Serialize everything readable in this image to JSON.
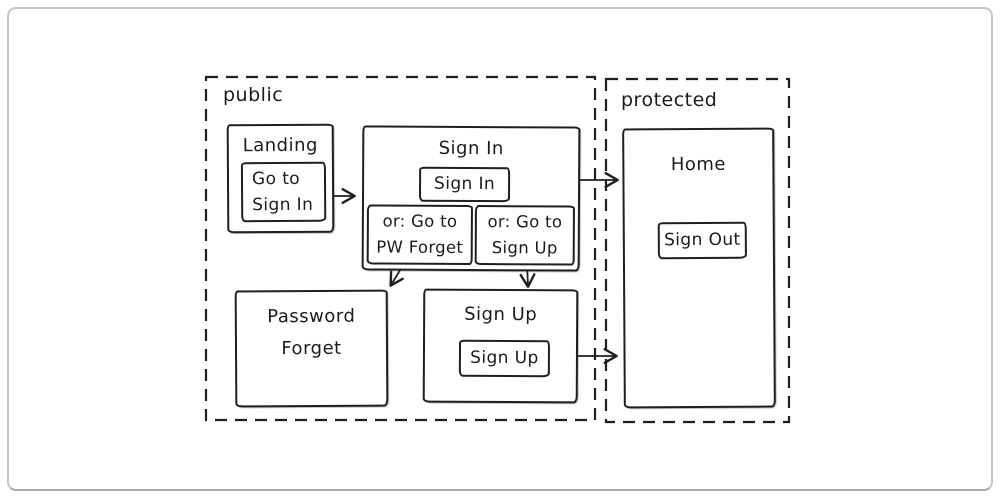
{
  "regions": {
    "public": {
      "label": "public"
    },
    "protected": {
      "label": "protected"
    }
  },
  "nodes": {
    "landing": {
      "title": "Landing",
      "button_line1": "Go to",
      "button_line2": "Sign In"
    },
    "sign_in": {
      "title": "Sign In",
      "button": "Sign In",
      "alt_pw_line1": "or: Go to",
      "alt_pw_line2": "PW Forget",
      "alt_su_line1": "or: Go to",
      "alt_su_line2": "Sign Up"
    },
    "password_forget": {
      "title_line1": "Password",
      "title_line2": "Forget"
    },
    "sign_up": {
      "title": "Sign Up",
      "button": "Sign Up"
    },
    "home": {
      "title": "Home",
      "button": "Sign Out"
    }
  },
  "edges": [
    {
      "from": "landing-go-to-sign-in-button",
      "to": "sign-in-box"
    },
    {
      "from": "sign-in-box",
      "to": "home-box"
    },
    {
      "from": "sign-in-alt-pw-forget",
      "to": "password-forget-box"
    },
    {
      "from": "sign-in-alt-sign-up",
      "to": "sign-up-box"
    },
    {
      "from": "sign-up-button",
      "to": "home-box"
    }
  ],
  "colors": {
    "stroke": "#1f1f1f",
    "background": "#ffffff",
    "frame_border": "#c6c6c6"
  }
}
